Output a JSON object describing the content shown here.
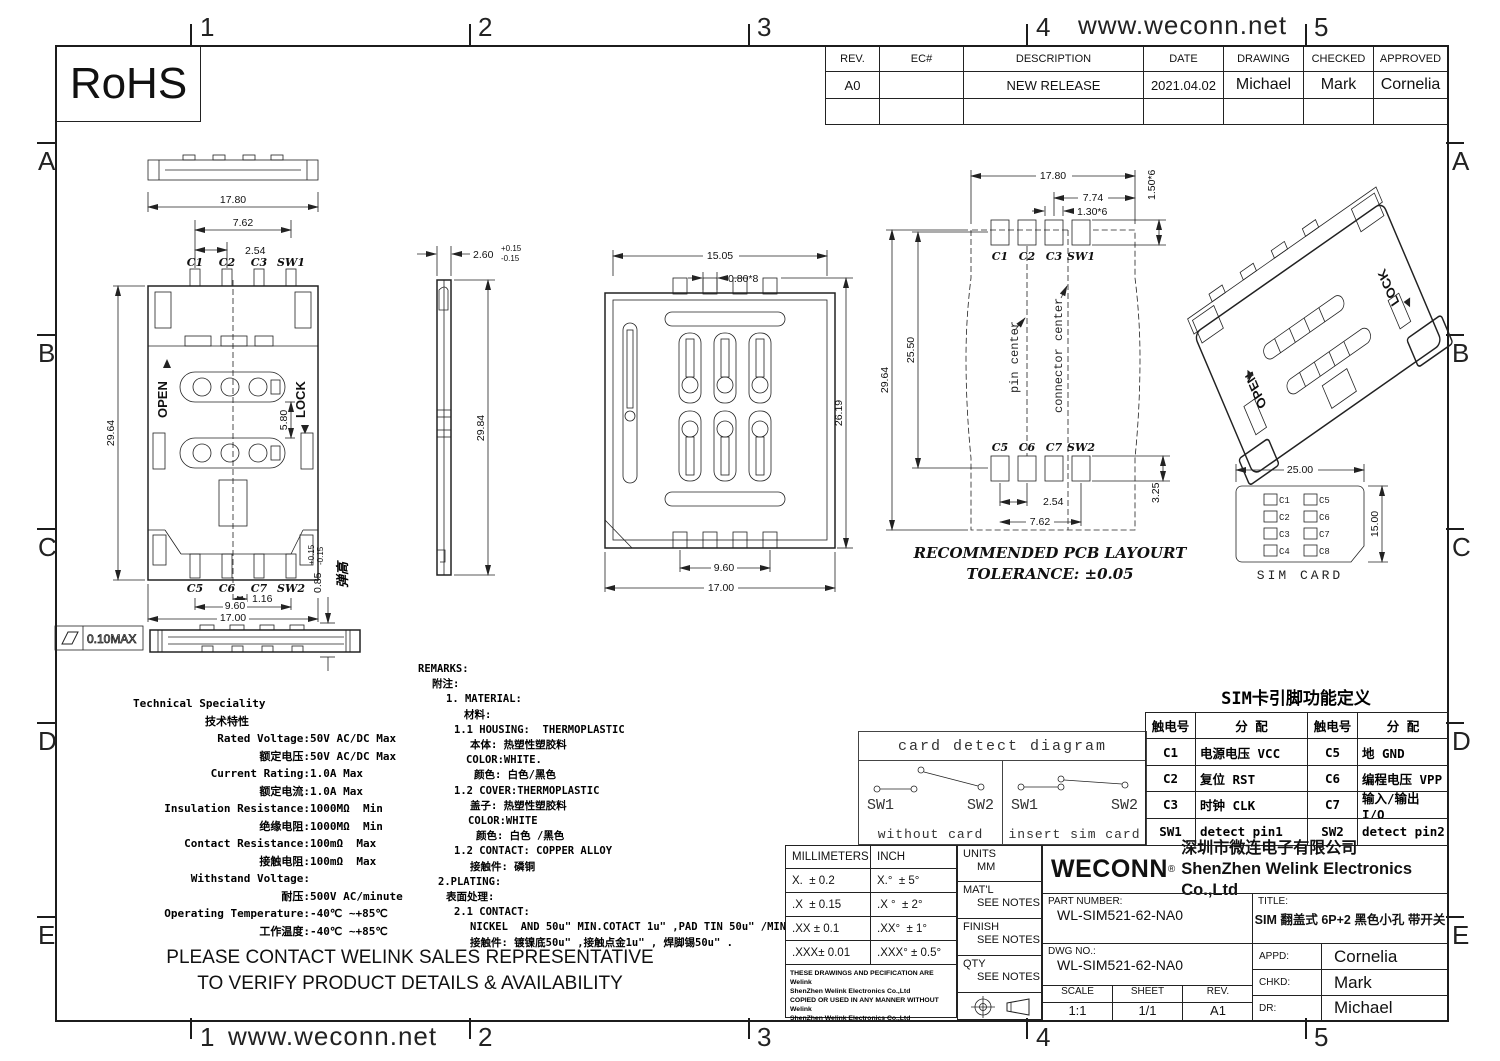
{
  "frame": {
    "url": "www.weconn.net",
    "cols": [
      "1",
      "2",
      "3",
      "4",
      "5"
    ],
    "rows": [
      "A",
      "B",
      "C",
      "D",
      "E"
    ],
    "rohs": "RoHS"
  },
  "revision_table": {
    "headers": [
      "REV.",
      "EC#",
      "DESCRIPTION",
      "DATE",
      "DRAWING",
      "CHECKED",
      "APPROVED"
    ],
    "row": [
      "A0",
      "",
      "NEW RELEASE",
      "2021.04.02",
      "Michael",
      "Mark",
      "Cornelia"
    ]
  },
  "views": {
    "plan": {
      "dim_width": "17.80",
      "dim_pin_span": "7.62",
      "dim_pitch": "2.54",
      "pins_top": [
        "C1",
        "C2",
        "C3",
        "SW1"
      ],
      "open_label": "OPEN",
      "lock_label": "LOCK",
      "dim_height": "29.64",
      "dim_slot_gap": "5.80",
      "pins_bottom": [
        "C5",
        "C6",
        "C7",
        "SW2"
      ],
      "dim_sw_offset": "1.16",
      "dim_pin_row": "9.60",
      "dim_body_width": "17.00"
    },
    "side": {
      "dim_thickness": "2.60",
      "tol_plus": "+0.15",
      "tol_minus": "-0.15",
      "dim_length": "29.84"
    },
    "bottom": {
      "dim_inner_width": "15.05",
      "dim_pin_width": "0.80*8",
      "dim_length": "26.19",
      "dim_pin_row": "9.60",
      "dim_width": "17.00"
    },
    "pcb": {
      "dim_width": "17.80",
      "dim_right_span": "7.74",
      "dim_pad_width": "1.30*6",
      "dim_pad_height": "1.50*6",
      "dim_height": "29.64",
      "dim_pad_span": "25.50",
      "pin_center_label": "pin center",
      "connector_center_label": "connector center",
      "pins_top": [
        "C1",
        "C2",
        "C3",
        "SW1"
      ],
      "pins_bottom": [
        "C5",
        "C6",
        "C7",
        "SW2"
      ],
      "dim_pitch": "2.54",
      "dim_pin_span": "7.62",
      "dim_pad_h2": "3.25",
      "note_line1": "RECOMMENDED PCB LAYOURT",
      "note_line2": "TOLERANCE: ±0.05"
    },
    "iso": {
      "open_label": "OPEN",
      "lock_label": "LOCK"
    },
    "simcard": {
      "dim_width": "25.00",
      "dim_height": "15.00",
      "pads_left": [
        "C1",
        "C2",
        "C3",
        "C4"
      ],
      "pads_right": [
        "C5",
        "C6",
        "C7",
        "C8"
      ],
      "caption": "SIM CARD"
    },
    "profile": {
      "flatness": "0.10MAX",
      "spring_height": "0.85",
      "tol_plus": "+0.15",
      "tol_minus": "-0.15",
      "spring_label": "弹高"
    }
  },
  "technical": {
    "title_en": "Technical Speciality",
    "title_cn": "技术特性",
    "rows": [
      {
        "label": "Rated Voltage:",
        "value": "50V AC/DC Max"
      },
      {
        "label": "额定电压:",
        "value": "50V AC/DC Max"
      },
      {
        "label": "Current Rating:",
        "value": "1.0A Max"
      },
      {
        "label": "额定电流:",
        "value": "1.0A Max"
      },
      {
        "label": "Insulation Resistance:",
        "value": "1000MΩ  Min"
      },
      {
        "label": "绝缘电阻:",
        "value": "1000MΩ  Min"
      },
      {
        "label": "Contact Resistance:",
        "value": "100mΩ  Max"
      },
      {
        "label": "接触电阻:",
        "value": "100mΩ  Max"
      },
      {
        "label": "Withstand Voltage:",
        "value": ""
      },
      {
        "label": "耐压:",
        "value": "500V AC/minute"
      },
      {
        "label": "Operating Temperature:",
        "value": "-40℃ ~+85℃"
      },
      {
        "label": "工作温度:",
        "value": "-40℃ ~+85℃"
      }
    ]
  },
  "remarks": {
    "lines": [
      "REMARKS:",
      "附注:",
      "1. MATERIAL:",
      "材料:",
      "1.1 HOUSING:  THERMOPLASTIC",
      "本体: 热塑性塑胶料",
      "COLOR:WHITE.",
      "颜色: 白色/黑色",
      "1.2 COVER:THERMOPLASTIC",
      "盖子: 热塑性塑胶料",
      "COLOR:WHITE",
      "颜色: 白色 /黑色",
      "1.2 CONTACT: COPPER ALLOY",
      "接触件: 磷铜",
      "2.PLATING:",
      "表面处理:",
      "2.1 CONTACT:",
      "NICKEL  AND 50u\" MIN.COTACT 1u\" ,PAD TIN 50u\" /MIN",
      "接触件: 镀镍底50u\" ,接触点金1u\" , 焊脚锡50u\" ."
    ]
  },
  "contact_note": {
    "line1": "PLEASE CONTACT WELINK SALES REPRESENTATIVE",
    "line2": "TO VERIFY PRODUCT DETAILS & AVAILABILITY"
  },
  "card_detect": {
    "title": "card detect diagram",
    "sw1": "SW1",
    "sw2": "SW2",
    "without": "without card",
    "insert": "insert sim card"
  },
  "pin_table": {
    "title": "SIM卡引脚功能定义",
    "headers": [
      "触电号",
      "分  配",
      "触电号",
      "分  配"
    ],
    "rows": [
      [
        "C1",
        "电源电压 VCC",
        "C5",
        "地 GND"
      ],
      [
        "C2",
        "复位 RST",
        "C6",
        "编程电压 VPP"
      ],
      [
        "C3",
        "时钟 CLK",
        "C7",
        "输入/输出 I/O"
      ],
      [
        "SW1",
        "detect pin1",
        "SW2",
        "detect pin2"
      ]
    ]
  },
  "title_block": {
    "tol_headers": [
      "MILLIMETERS",
      "INCH"
    ],
    "tol_rows": [
      [
        "X.  ± 0.2",
        "X.°  ± 5°"
      ],
      [
        ".X  ± 0.15",
        ".X °  ± 2°"
      ],
      [
        ".XX ± 0.1",
        ".XX°  ± 1°"
      ],
      [
        ".XXX± 0.01",
        ".XXX° ± 0.5°"
      ]
    ],
    "legal1": "THESE DRAWINGS AND PECIFICATION  ARE Welink",
    "legal2": "ShenZhen Welink Electronics Co.,Ltd",
    "legal3": "COPIED OR USED IN ANY MANNER WITHOUT Welink",
    "legal4": "ShenZhen Welink Electronics Co.,Ltd",
    "units_label": "UNITS",
    "units": "MM",
    "matl_label": "MAT'L",
    "matl": "SEE NOTES",
    "finish_label": "FINISH",
    "finish": "SEE NOTES",
    "qty_label": "QTY",
    "qty": "SEE NOTES",
    "logo": "WECONN",
    "reg": "®",
    "company_cn": "深圳市微连电子有限公司",
    "company_en": "ShenZhen Welink Electronics Co.,Ltd",
    "part_number_label": "PART NUMBER:",
    "part_number": "WL-SIM521-62-NA0",
    "title_label": "TITLE:",
    "title": "SIM 翻盖式 6P+2 黑色小孔 带开关",
    "dwg_no_label": "DWG NO.:",
    "dwg_no": "WL-SIM521-62-NA0",
    "scale_label": "SCALE",
    "scale": "1:1",
    "sheet_label": "SHEET",
    "sheet": "1/1",
    "rev_label": "REV.",
    "rev": "A1",
    "appd_label": "APPD:",
    "appd": "Cornelia",
    "chkd_label": "CHKD:",
    "chkd": "Mark",
    "dr_label": "DR:",
    "dr": "Michael"
  }
}
